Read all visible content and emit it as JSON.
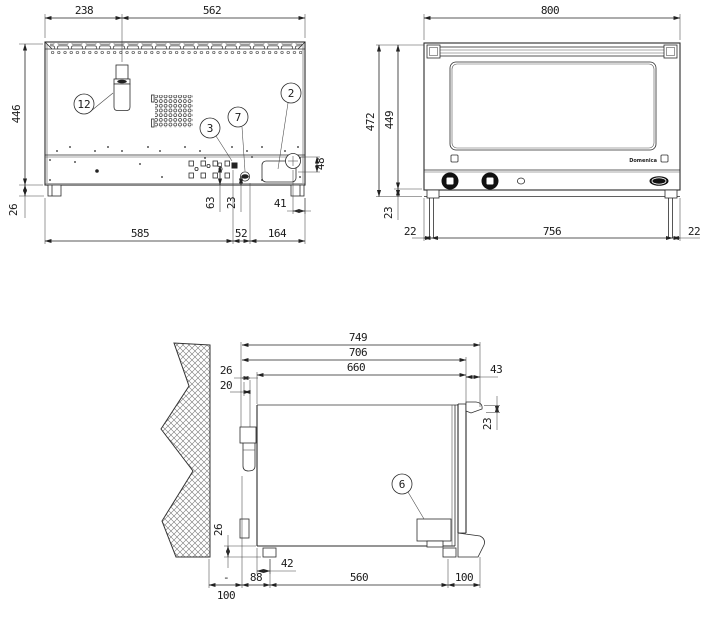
{
  "rear": {
    "d238": "238",
    "d562": "562",
    "d446": "446",
    "d26": "26",
    "d585": "585",
    "d52": "52",
    "d164": "164",
    "d63": "63",
    "d23": "23",
    "d41": "41",
    "d48": "48",
    "c12": "12",
    "c3": "3",
    "c7": "7",
    "c2": "2"
  },
  "front": {
    "d800": "800",
    "d472": "472",
    "d449": "449",
    "d23": "23",
    "d22l": "22",
    "d756": "756",
    "d22r": "22",
    "brand": "Domenica"
  },
  "side": {
    "d749": "749",
    "d706": "706",
    "d660": "660",
    "d26t": "26",
    "d20": "20",
    "d43": "43",
    "d23": "23",
    "d26b": "26",
    "d42": "42",
    "d88": "88",
    "d560": "560",
    "d100l": "100",
    "dash": "-",
    "d100r": "100",
    "c6": "6"
  },
  "colors": {
    "line": "#2b2b2b",
    "light_line": "#9a9a9a",
    "fill": "#ffffff"
  }
}
